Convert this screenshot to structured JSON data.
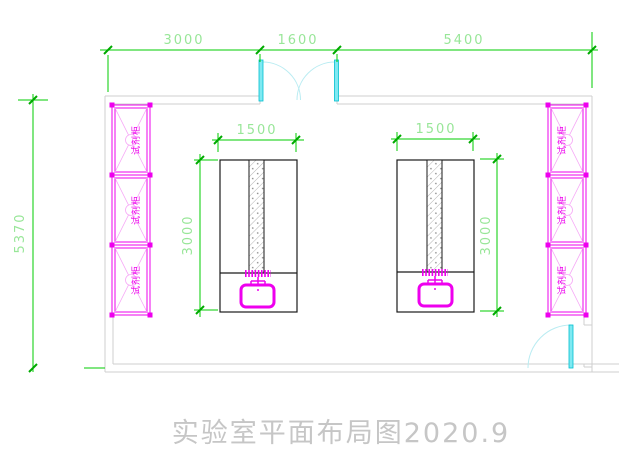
{
  "drawing": {
    "title": "实验室平面布局图2020.9",
    "dimensions": {
      "top_row": [
        {
          "label": "3000"
        },
        {
          "label": "1600"
        },
        {
          "label": "5400"
        }
      ],
      "left_height": "5370",
      "left_bench": {
        "width": "1500",
        "depth": "3000"
      },
      "right_bench": {
        "width": "1500",
        "depth": "3000"
      }
    },
    "cabinets": {
      "label": "试剂柜",
      "left_column_count": 3,
      "right_column_count": 3
    },
    "colors": {
      "dimension_line": "#00cc00",
      "dimension_text": "#98e698",
      "wall": "#cfcfcf",
      "cabinet": "#ee00ee",
      "cabinet_cross": "#f6a6f6",
      "door_leaf": "#00e0ea",
      "door_swing": "#b9ecf2",
      "bench_outline": "#1a1a1a",
      "title_text": "#c6c6c6"
    }
  }
}
